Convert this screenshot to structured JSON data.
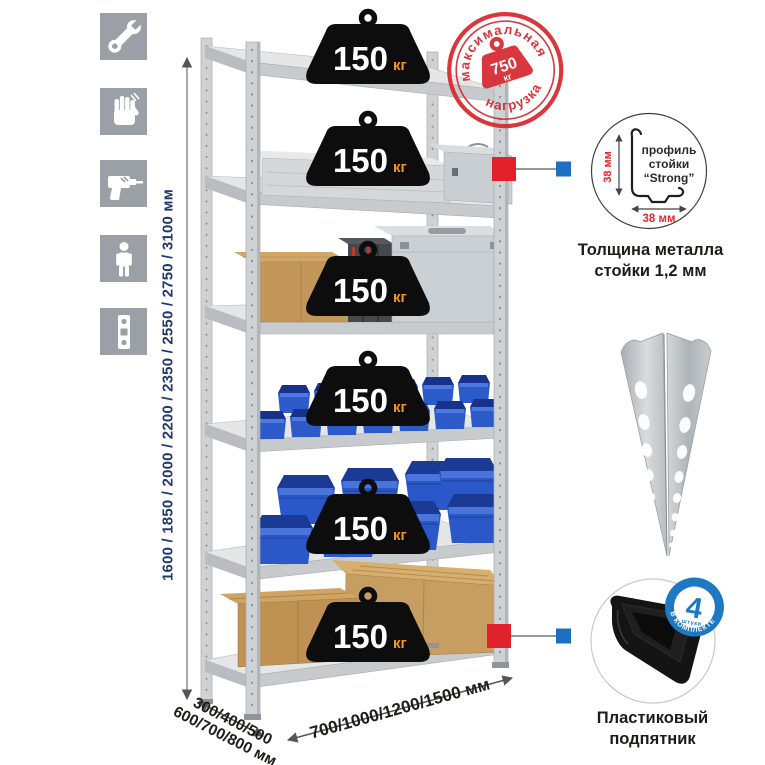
{
  "colors": {
    "accent_red": "#d7282f",
    "accent_blue": "#1d79c2",
    "connector_red": "#e2222a",
    "connector_blue": "#1d6fc2",
    "dimension_text_navy": "#20386b",
    "weight_unit_orange": "#f7941e",
    "icon_tile_gray": "#9aa0a5",
    "bin_blue": "#2c5bc9",
    "cardboard_tan": "#c29759",
    "metal_gray": "#ced2d5"
  },
  "left_icons": {
    "items": [
      {
        "name": "wrench-icon"
      },
      {
        "name": "gloves-icon"
      },
      {
        "name": "drill-icon"
      },
      {
        "name": "person-icon"
      },
      {
        "name": "post-profile-icon"
      }
    ]
  },
  "height_dimension": {
    "label": "1600 / 1850 / 2000 / 2200 / 2350 / 2550 / 2750 / 3100 мм"
  },
  "depth_dimension": {
    "line1": "300/400/500",
    "line2": "600/700/800 мм"
  },
  "width_dimension": {
    "label": "700/1000/1200/1500 мм"
  },
  "shelf_weights": {
    "items": [
      {
        "value": "150",
        "unit": "кг"
      },
      {
        "value": "150",
        "unit": "кг"
      },
      {
        "value": "150",
        "unit": "кг"
      },
      {
        "value": "150",
        "unit": "кг"
      },
      {
        "value": "150",
        "unit": "кг"
      },
      {
        "value": "150",
        "unit": "кг"
      }
    ]
  },
  "max_load_stamp": {
    "arc_top": "максимальная",
    "arc_bottom": "нагрузка",
    "value": "750",
    "unit": "кг"
  },
  "profile_callout": {
    "line1": "профиль",
    "line2": "стойки",
    "line3": "“Strong”",
    "dim_vertical": "38 мм",
    "dim_horizontal": "38 мм",
    "caption_line1": "Толщина металла",
    "caption_line2": "стойки 1,2 мм"
  },
  "foot_callout": {
    "badge_value": "4",
    "badge_sub": "штуки",
    "badge_arc": "В КОМПЛЕКТЕ",
    "caption_line1": "Пластиковый",
    "caption_line2": "подпятник"
  }
}
